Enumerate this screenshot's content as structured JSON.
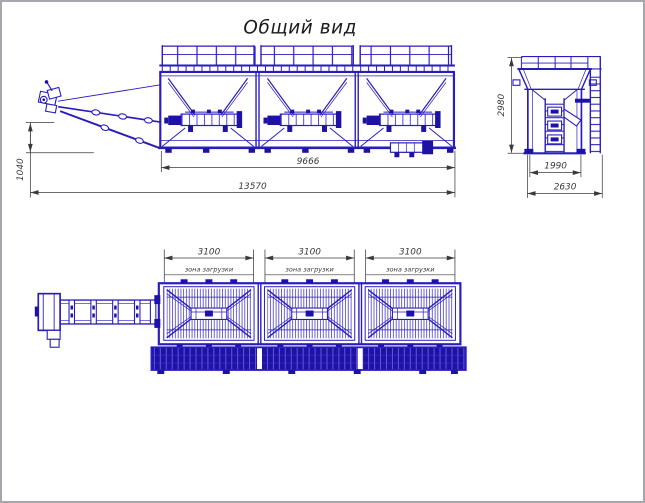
{
  "title": "Общий вид",
  "colors": {
    "drawing_blue": "#2a1dbe",
    "drawing_blue_dark": "#1d11a6",
    "dimension_gray": "#3a3a3a",
    "sheet_border": "#a6a6ae",
    "background": "#ffffff"
  },
  "side_view": {
    "dim_hitch_height": "1040",
    "dim_hopper_length": "9666",
    "dim_overall_length": "13570"
  },
  "end_view": {
    "dim_overall_height": "2980",
    "dim_frame_width": "1990",
    "dim_overall_width": "2630"
  },
  "plan_view": {
    "sections": [
      {
        "dim_width": "3100",
        "zone_label": "зона загрузки"
      },
      {
        "dim_width": "3100",
        "zone_label": "зона загрузки"
      },
      {
        "dim_width": "3100",
        "zone_label": "зона загрузки"
      }
    ]
  }
}
